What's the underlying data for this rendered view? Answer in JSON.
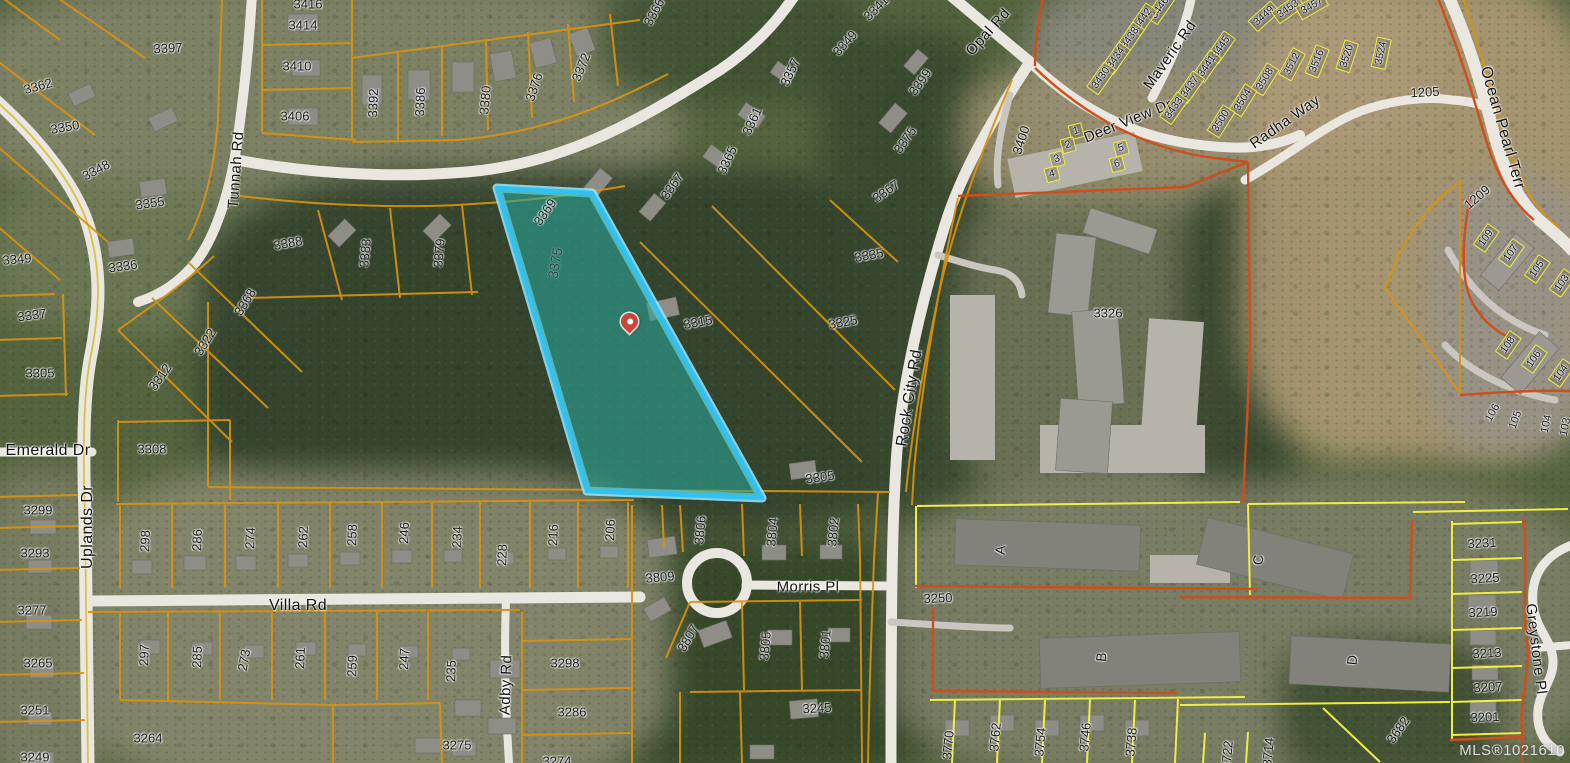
{
  "map": {
    "watermark": "MLS®1021610",
    "highlight": {
      "parcel_number": "3375",
      "outline_color": "#2fc2f2",
      "glow_color": "#9ae6ff",
      "fill_color": "#2aa79b",
      "fill_opacity": 0.58,
      "pin_color": "#c9473a"
    },
    "colors": {
      "parcel_line": "#d8930f",
      "subdivision_line": "#eeee41",
      "boundary_line": "#cf4e1b",
      "road_fill": "#e9e7df",
      "road_centerline": "#d9c243"
    },
    "road_labels": [
      {
        "t": "Tunnah Rd",
        "x": 236,
        "y": 170,
        "r": -86
      },
      {
        "t": "Opal Rd",
        "x": 988,
        "y": 32,
        "r": -48
      },
      {
        "t": "Deer View Dr",
        "x": 1128,
        "y": 121,
        "r": -22
      },
      {
        "t": "Maveric Rd",
        "x": 1170,
        "y": 55,
        "r": -55
      },
      {
        "t": "Radha Way",
        "x": 1285,
        "y": 122,
        "r": -35
      },
      {
        "t": "Ocean Pearl Terr",
        "x": 1502,
        "y": 128,
        "r": 74,
        "s": 16
      },
      {
        "t": "Rock City Rd",
        "x": 910,
        "y": 398,
        "r": -81,
        "s": 16
      },
      {
        "t": "Emerald Dr",
        "x": 48,
        "y": 451,
        "r": 0,
        "s": 16
      },
      {
        "t": "Uplands Dr",
        "x": 88,
        "y": 527,
        "r": -90,
        "s": 16
      },
      {
        "t": "Villa Rd",
        "x": 298,
        "y": 606,
        "r": 0,
        "s": 16
      },
      {
        "t": "Adby Rd",
        "x": 506,
        "y": 685,
        "r": -88
      },
      {
        "t": "Morris Pl",
        "x": 808,
        "y": 587,
        "r": 0
      },
      {
        "t": "Greystone Pl",
        "x": 1536,
        "y": 649,
        "r": 83
      }
    ],
    "lot_labels": [
      {
        "t": "3397",
        "x": 168,
        "y": 48,
        "r": -3
      },
      {
        "t": "3416",
        "x": 308,
        "y": 4,
        "r": 0
      },
      {
        "t": "3414",
        "x": 303,
        "y": 25,
        "r": 0
      },
      {
        "t": "3410",
        "x": 297,
        "y": 66,
        "r": 0
      },
      {
        "t": "3406",
        "x": 295,
        "y": 116,
        "r": 0
      },
      {
        "t": "3392",
        "x": 373,
        "y": 103,
        "r": -88
      },
      {
        "t": "3386",
        "x": 420,
        "y": 102,
        "r": -88
      },
      {
        "t": "3380",
        "x": 485,
        "y": 100,
        "r": -85
      },
      {
        "t": "3376",
        "x": 534,
        "y": 87,
        "r": -72
      },
      {
        "t": "3372",
        "x": 581,
        "y": 67,
        "r": -68
      },
      {
        "t": "3366",
        "x": 654,
        "y": 12,
        "r": -62
      },
      {
        "t": "3362",
        "x": 38,
        "y": 86,
        "r": -15
      },
      {
        "t": "3350",
        "x": 65,
        "y": 127,
        "r": -10
      },
      {
        "t": "3348",
        "x": 96,
        "y": 170,
        "r": -28
      },
      {
        "t": "3355",
        "x": 150,
        "y": 203,
        "r": -8
      },
      {
        "t": "3336",
        "x": 123,
        "y": 266,
        "r": -8
      },
      {
        "t": "3388",
        "x": 288,
        "y": 243,
        "r": -10
      },
      {
        "t": "3383",
        "x": 365,
        "y": 253,
        "r": -85
      },
      {
        "t": "3379",
        "x": 439,
        "y": 253,
        "r": -85
      },
      {
        "t": "3369",
        "x": 545,
        "y": 212,
        "r": -55
      },
      {
        "t": "3367",
        "x": 672,
        "y": 186,
        "r": -55
      },
      {
        "t": "3357",
        "x": 790,
        "y": 72,
        "r": -65
      },
      {
        "t": "3361",
        "x": 752,
        "y": 121,
        "r": -65
      },
      {
        "t": "3365",
        "x": 727,
        "y": 160,
        "r": -65
      },
      {
        "t": "3341",
        "x": 876,
        "y": 8,
        "r": -45
      },
      {
        "t": "3349",
        "x": 845,
        "y": 43,
        "r": -48
      },
      {
        "t": "3399",
        "x": 920,
        "y": 82,
        "r": -55
      },
      {
        "t": "3375",
        "x": 905,
        "y": 140,
        "r": -55
      },
      {
        "t": "3367",
        "x": 886,
        "y": 191,
        "r": -35
      },
      {
        "t": "3335",
        "x": 869,
        "y": 255,
        "r": -10
      },
      {
        "t": "3375",
        "x": 555,
        "y": 263,
        "r": -80,
        "c": "hl"
      },
      {
        "t": "3325",
        "x": 843,
        "y": 322,
        "r": -10
      },
      {
        "t": "3315",
        "x": 698,
        "y": 322,
        "r": -10
      },
      {
        "t": "3305",
        "x": 820,
        "y": 477,
        "r": -8
      },
      {
        "t": "3349",
        "x": 17,
        "y": 259,
        "r": -5
      },
      {
        "t": "3337",
        "x": 32,
        "y": 315,
        "r": -8
      },
      {
        "t": "3305",
        "x": 40,
        "y": 373,
        "r": 0
      },
      {
        "t": "3312",
        "x": 160,
        "y": 377,
        "r": -55
      },
      {
        "t": "3322",
        "x": 205,
        "y": 342,
        "r": -58
      },
      {
        "t": "3368",
        "x": 245,
        "y": 302,
        "r": -58
      },
      {
        "t": "3308",
        "x": 152,
        "y": 449,
        "r": 0
      },
      {
        "t": "3299",
        "x": 38,
        "y": 510,
        "r": 0
      },
      {
        "t": "3293",
        "x": 35,
        "y": 553,
        "r": 0
      },
      {
        "t": "3277",
        "x": 32,
        "y": 610,
        "r": 0
      },
      {
        "t": "3265",
        "x": 38,
        "y": 663,
        "r": 0
      },
      {
        "t": "3251",
        "x": 35,
        "y": 710,
        "r": 0
      },
      {
        "t": "3249",
        "x": 35,
        "y": 757,
        "r": 0
      },
      {
        "t": "3264",
        "x": 148,
        "y": 738,
        "r": 0
      },
      {
        "t": "3275",
        "x": 457,
        "y": 745,
        "r": 0
      },
      {
        "t": "3298",
        "x": 565,
        "y": 663,
        "r": 0
      },
      {
        "t": "3286",
        "x": 572,
        "y": 712,
        "r": 0
      },
      {
        "t": "3274",
        "x": 557,
        "y": 761,
        "r": 0
      },
      {
        "t": "297",
        "x": 144,
        "y": 655,
        "r": -88
      },
      {
        "t": "285",
        "x": 197,
        "y": 657,
        "r": -88
      },
      {
        "t": "273",
        "x": 244,
        "y": 660,
        "r": -80
      },
      {
        "t": "261",
        "x": 300,
        "y": 658,
        "r": -88
      },
      {
        "t": "259",
        "x": 352,
        "y": 666,
        "r": -88
      },
      {
        "t": "247",
        "x": 404,
        "y": 659,
        "r": -88
      },
      {
        "t": "235",
        "x": 451,
        "y": 671,
        "r": -88
      },
      {
        "t": "298",
        "x": 145,
        "y": 541,
        "r": -88
      },
      {
        "t": "286",
        "x": 197,
        "y": 540,
        "r": -88
      },
      {
        "t": "274",
        "x": 250,
        "y": 538,
        "r": -88
      },
      {
        "t": "262",
        "x": 303,
        "y": 537,
        "r": -88
      },
      {
        "t": "258",
        "x": 352,
        "y": 535,
        "r": -88
      },
      {
        "t": "246",
        "x": 404,
        "y": 533,
        "r": -88
      },
      {
        "t": "234",
        "x": 457,
        "y": 537,
        "r": -88
      },
      {
        "t": "228",
        "x": 502,
        "y": 555,
        "r": -88
      },
      {
        "t": "216",
        "x": 553,
        "y": 535,
        "r": -88
      },
      {
        "t": "206",
        "x": 610,
        "y": 530,
        "r": -88
      },
      {
        "t": "3809",
        "x": 660,
        "y": 577,
        "r": -5
      },
      {
        "t": "3806",
        "x": 700,
        "y": 530,
        "r": -85
      },
      {
        "t": "3804",
        "x": 772,
        "y": 532,
        "r": -85
      },
      {
        "t": "3802",
        "x": 833,
        "y": 532,
        "r": -85
      },
      {
        "t": "3807",
        "x": 688,
        "y": 638,
        "r": -60
      },
      {
        "t": "3805",
        "x": 765,
        "y": 646,
        "r": -85
      },
      {
        "t": "3801",
        "x": 825,
        "y": 644,
        "r": -85
      },
      {
        "t": "3245",
        "x": 817,
        "y": 708,
        "r": -3
      },
      {
        "t": "3250",
        "x": 938,
        "y": 598,
        "r": -2
      },
      {
        "t": "A",
        "x": 1000,
        "y": 550,
        "r": -85,
        "s": 14
      },
      {
        "t": "B",
        "x": 1101,
        "y": 657,
        "r": -85,
        "s": 14
      },
      {
        "t": "C",
        "x": 1258,
        "y": 560,
        "r": -85,
        "s": 14
      },
      {
        "t": "D",
        "x": 1352,
        "y": 660,
        "r": -85,
        "s": 14
      },
      {
        "t": "3770",
        "x": 948,
        "y": 745,
        "r": -85
      },
      {
        "t": "3762",
        "x": 995,
        "y": 737,
        "r": -85
      },
      {
        "t": "3754",
        "x": 1040,
        "y": 742,
        "r": -85
      },
      {
        "t": "3746",
        "x": 1085,
        "y": 737,
        "r": -85
      },
      {
        "t": "3738",
        "x": 1131,
        "y": 742,
        "r": -85
      },
      {
        "t": "3722",
        "x": 1227,
        "y": 755,
        "r": -85
      },
      {
        "t": "3714",
        "x": 1268,
        "y": 752,
        "r": -85
      },
      {
        "t": "3682",
        "x": 1398,
        "y": 730,
        "r": -55
      },
      {
        "t": "3231",
        "x": 1482,
        "y": 543,
        "r": -3
      },
      {
        "t": "3225",
        "x": 1485,
        "y": 578,
        "r": -3
      },
      {
        "t": "3219",
        "x": 1483,
        "y": 612,
        "r": -3
      },
      {
        "t": "3213",
        "x": 1487,
        "y": 653,
        "r": -3
      },
      {
        "t": "3207",
        "x": 1488,
        "y": 687,
        "r": -3
      },
      {
        "t": "3201",
        "x": 1485,
        "y": 717,
        "r": -2
      },
      {
        "t": "3326",
        "x": 1108,
        "y": 313,
        "r": 0
      },
      {
        "t": "3400",
        "x": 1021,
        "y": 140,
        "r": -72
      },
      {
        "t": "1205",
        "x": 1425,
        "y": 92,
        "r": -3
      },
      {
        "t": "1209",
        "x": 1477,
        "y": 197,
        "r": -40
      },
      {
        "t": "106",
        "x": 1493,
        "y": 413,
        "r": -60,
        "s": 11
      },
      {
        "t": "105",
        "x": 1516,
        "y": 420,
        "r": -70,
        "s": 11
      },
      {
        "t": "104",
        "x": 1547,
        "y": 424,
        "r": -78,
        "s": 11
      },
      {
        "t": "103",
        "x": 1566,
        "y": 427,
        "r": -78,
        "s": 11
      }
    ],
    "boxed_lot_labels": [
      {
        "t": "3446",
        "x": 1160,
        "y": 8,
        "r": -55
      },
      {
        "t": "3442",
        "x": 1143,
        "y": 19,
        "r": -55
      },
      {
        "t": "3438",
        "x": 1130,
        "y": 38,
        "r": -55
      },
      {
        "t": "3434",
        "x": 1116,
        "y": 58,
        "r": -55
      },
      {
        "t": "3430",
        "x": 1101,
        "y": 78,
        "r": -55
      },
      {
        "t": "3445",
        "x": 1221,
        "y": 47,
        "r": -55
      },
      {
        "t": "3441",
        "x": 1207,
        "y": 66,
        "r": -55
      },
      {
        "t": "3437",
        "x": 1190,
        "y": 87,
        "r": -55
      },
      {
        "t": "3433",
        "x": 1174,
        "y": 108,
        "r": -55
      },
      {
        "t": "3449",
        "x": 1264,
        "y": 16,
        "r": -42
      },
      {
        "t": "3453",
        "x": 1288,
        "y": 9,
        "r": -35
      },
      {
        "t": "3457",
        "x": 1312,
        "y": 6,
        "r": -30
      },
      {
        "t": "3508",
        "x": 1265,
        "y": 79,
        "r": -58
      },
      {
        "t": "3504",
        "x": 1243,
        "y": 100,
        "r": -58
      },
      {
        "t": "3500",
        "x": 1221,
        "y": 121,
        "r": -58
      },
      {
        "t": "3512",
        "x": 1292,
        "y": 64,
        "r": -62
      },
      {
        "t": "3516",
        "x": 1317,
        "y": 61,
        "r": -68
      },
      {
        "t": "3520",
        "x": 1347,
        "y": 56,
        "r": -72
      },
      {
        "t": "3524",
        "x": 1381,
        "y": 53,
        "r": -78
      },
      {
        "t": "1",
        "x": 1076,
        "y": 131,
        "r": -15
      },
      {
        "t": "2",
        "x": 1068,
        "y": 145,
        "r": -15
      },
      {
        "t": "3",
        "x": 1057,
        "y": 159,
        "r": -15
      },
      {
        "t": "4",
        "x": 1052,
        "y": 174,
        "r": -15
      },
      {
        "t": "5",
        "x": 1121,
        "y": 148,
        "r": -15
      },
      {
        "t": "6",
        "x": 1117,
        "y": 164,
        "r": -15
      },
      {
        "t": "109",
        "x": 1486,
        "y": 238,
        "r": -55
      },
      {
        "t": "107",
        "x": 1511,
        "y": 253,
        "r": -55
      },
      {
        "t": "105",
        "x": 1537,
        "y": 269,
        "r": -55
      },
      {
        "t": "103",
        "x": 1562,
        "y": 283,
        "r": -55
      },
      {
        "t": "108",
        "x": 1508,
        "y": 345,
        "r": -55
      },
      {
        "t": "106",
        "x": 1534,
        "y": 359,
        "r": -55
      },
      {
        "t": "104",
        "x": 1561,
        "y": 373,
        "r": -55
      }
    ]
  }
}
